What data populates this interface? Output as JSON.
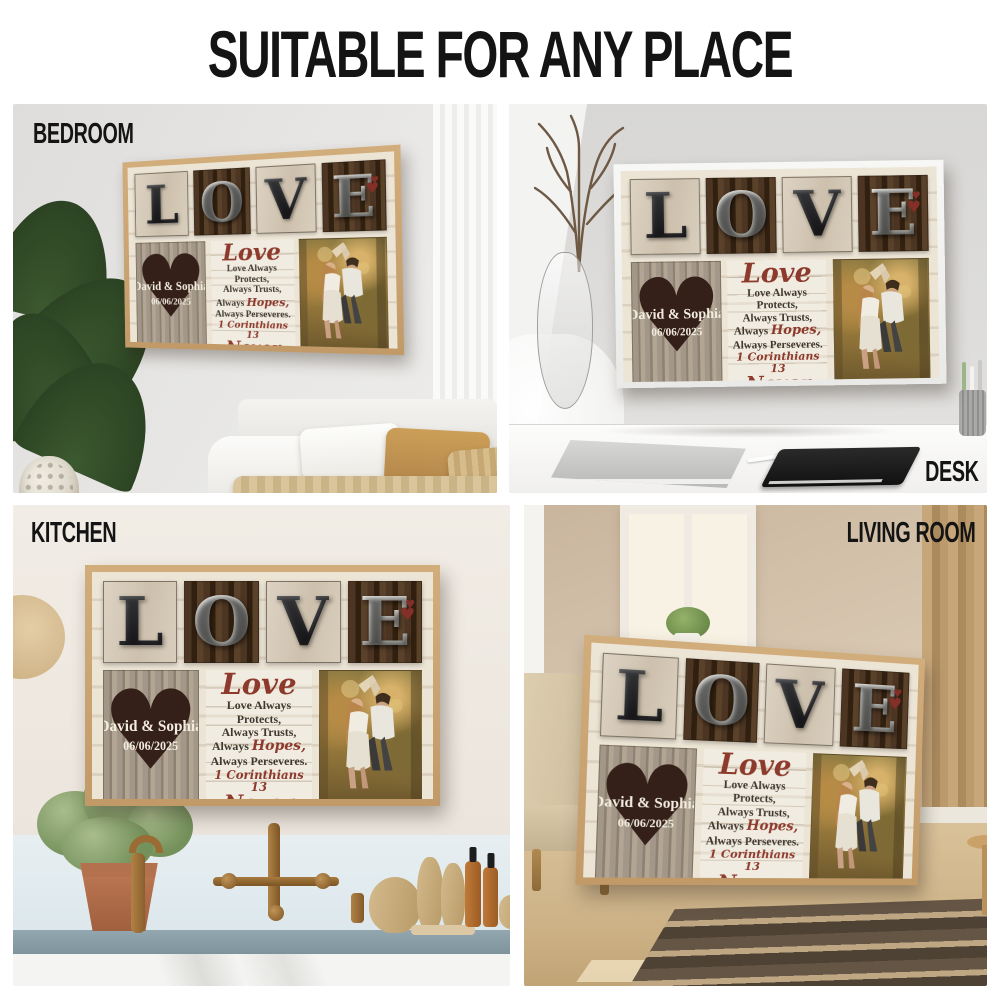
{
  "header": {
    "title": "SUITABLE FOR ANY PLACE"
  },
  "scenes": {
    "bedroom": {
      "label": "BEDROOM"
    },
    "desk": {
      "label": "DESK"
    },
    "kitchen": {
      "label": "KITCHEN"
    },
    "living_room": {
      "label": "LIVING ROOM"
    }
  },
  "poster": {
    "letters": [
      "L",
      "O",
      "V",
      "E"
    ],
    "heart_panel": {
      "names": "David & Sophia",
      "date": "06/06/2025"
    },
    "message": {
      "script_title": "Love",
      "line1": "Love Always Protects,",
      "line2": "Always Trusts,",
      "line3_prefix": "Always ",
      "line3_word": "Hopes,",
      "line4": "Always Perseveres.",
      "verse": "1 Corinthians 13",
      "closing": "Never Fails"
    },
    "icons": {
      "heart": "♥"
    },
    "colors": {
      "accent_red": "#8d3a2d",
      "frame_tan": "#c8a474",
      "frame_white": "#f4f4f2",
      "heart_dark": "#342019",
      "letter_silver": "#d6d6d3",
      "letter_gunmetal": "#3f4044"
    }
  }
}
